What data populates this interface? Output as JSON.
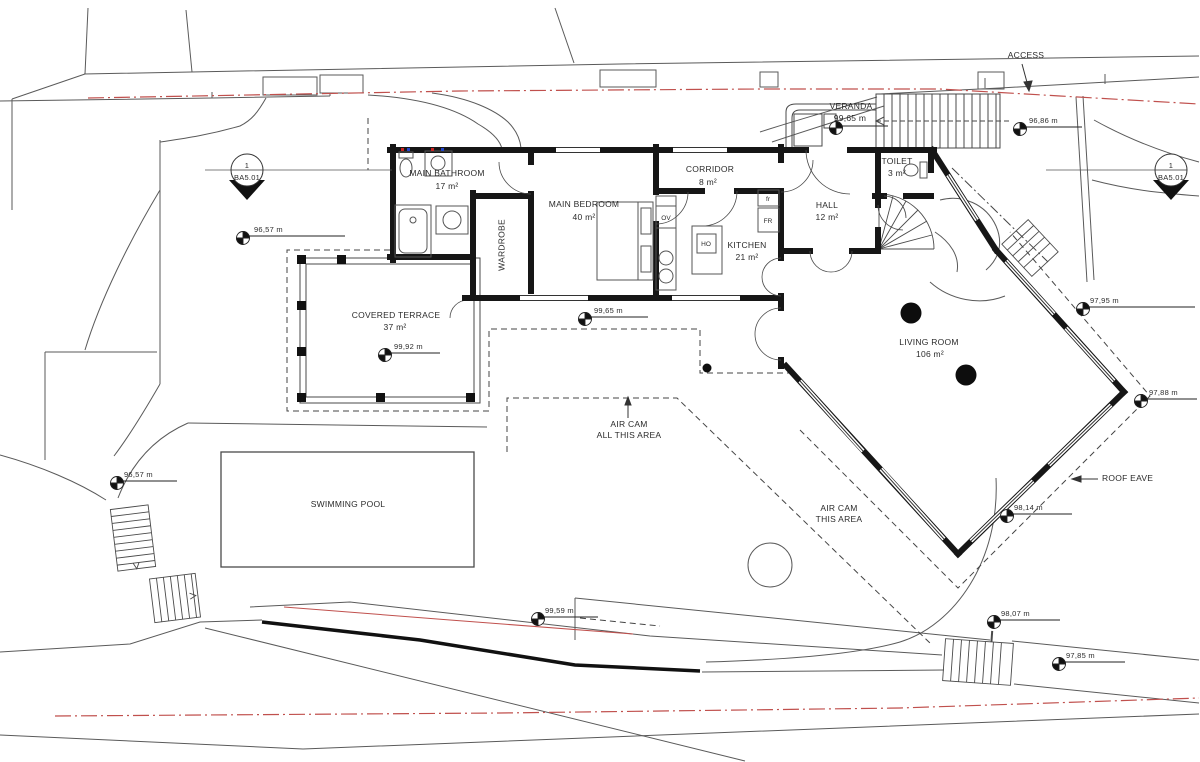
{
  "plan": {
    "section": {
      "num": "1",
      "code": "BA5.01"
    },
    "rooms": {
      "bathroom": {
        "name": "MAIN BATHROOM",
        "area": "17 m²"
      },
      "bedroom": {
        "name": "MAIN BEDROOM",
        "area": "40 m²"
      },
      "wardrobe": {
        "name": "WARDROBE"
      },
      "corridor": {
        "name": "CORRIDOR",
        "area": "8 m²"
      },
      "kitchen": {
        "name": "KITCHEN",
        "area": "21 m²"
      },
      "hall": {
        "name": "HALL",
        "area": "12 m²"
      },
      "toilet": {
        "name": "TOILET",
        "area": "3 m²"
      },
      "veranda": {
        "name": "VERANDA",
        "elevation": "99,65 m"
      },
      "terrace": {
        "name": "COVERED TERRACE",
        "area": "37 m²"
      },
      "living": {
        "name": "LIVING ROOM",
        "area": "106 m²"
      },
      "pool": {
        "name": "SWIMMING POOL"
      }
    },
    "notes": {
      "access": "ACCESS",
      "roof_eave": "ROOF EAVE",
      "air_cam_all": "AIR CAM\nALL THIS AREA",
      "air_cam_this": "AIR CAM\nTHIS AREA"
    },
    "appliances": {
      "fridge_small": "fr",
      "fridge": "FR",
      "hob": "HO",
      "oven": "OV"
    },
    "elevations": {
      "left_upper": "96,57 m",
      "below_bedroom": "99,65 m",
      "terrace": "99,92 m",
      "top_right": "96,86 m",
      "right_upper": "97,95 m",
      "right_mid": "97,88 m",
      "below_living": "98,14 m",
      "bottom_right_upper": "98,07 m",
      "bottom_right_lower": "97,85 m",
      "bottom_middle": "99,59 m",
      "left_lower": "96,57 m"
    },
    "colors": {
      "boundary_red": "#c0504d",
      "wall": "#161616",
      "line": "#4a4a4a"
    }
  }
}
